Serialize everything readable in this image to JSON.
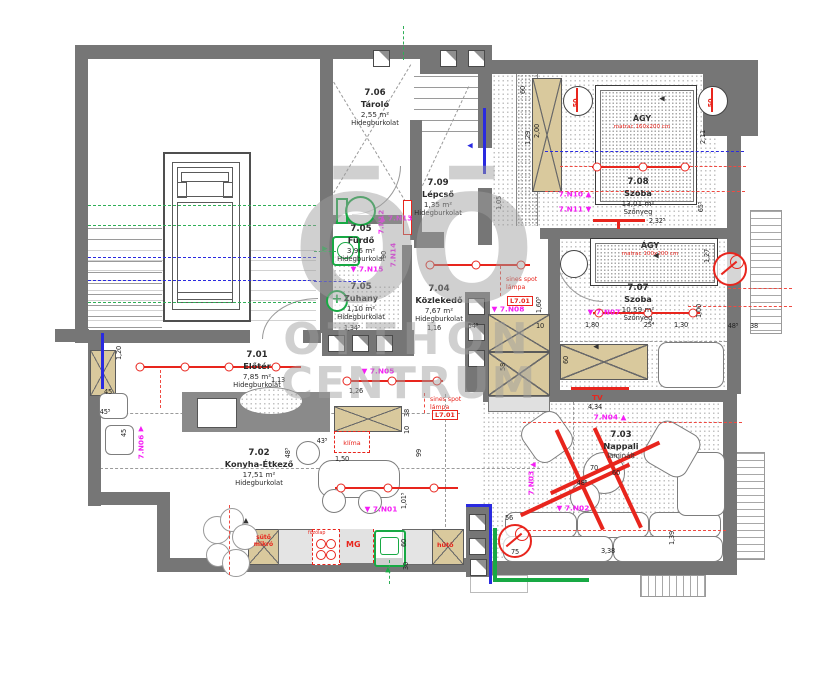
{
  "watermark": {
    "logo": "ŌŌ",
    "line1": "OTTHON",
    "line2": "CENTRUM"
  },
  "rooms": [
    {
      "id": "7.06",
      "name": "Tároló",
      "area": "2,55 m²",
      "floor": "Hidegburkolat"
    },
    {
      "id": "7.09",
      "name": "Lépcső",
      "area": "1,35 m²",
      "floor": "Hidegburkolat"
    },
    {
      "id": "7.05",
      "name": "Fürdő",
      "area": "3,96 m²",
      "floor": "Hidegburkolat"
    },
    {
      "id": "7.05",
      "name": "Zuhany",
      "area": "1,10 m²",
      "floor": "Hidegburkolat"
    },
    {
      "id": "7.04",
      "name": "Közlekedő",
      "area": "7,67 m²",
      "floor": "Hidegburkolat"
    },
    {
      "id": "7.01",
      "name": "Előtér",
      "area": "7,85 m²",
      "floor": "Hidegburkolat"
    },
    {
      "id": "7.02",
      "name": "Konyha-Étkező",
      "area": "17,51 m²",
      "floor": "Hidegburkolat"
    },
    {
      "id": "7.03",
      "name": "Nappali",
      "area": "",
      "floor": "laminált"
    },
    {
      "id": "7.08",
      "name": "Szoba",
      "area": "13,01 m²",
      "floor": "Szőnyeg"
    },
    {
      "id": "7.07",
      "name": "Szoba",
      "area": "10,59 m²",
      "floor": "Szőnyeg"
    }
  ],
  "furniture": {
    "bed_large": {
      "label": "ÁGY",
      "sub": "matrac 160x200 cm"
    },
    "bed_small": {
      "label": "ÁGY",
      "sub": "matrac 100x200 cm"
    },
    "tv": "TV"
  },
  "appliances": {
    "oven1": "sütő",
    "oven2": "mikró",
    "cooktop": "főzőlap",
    "dishwasher": "MG",
    "fridge": "hűtő",
    "klima": "klíma"
  },
  "lighting": {
    "line1": "sines spot",
    "line2": "lámpa",
    "code": "L7.01"
  },
  "dimensions": [
    {
      "t": "2,32⁵",
      "x": 657,
      "y": 221
    },
    {
      "t": "2,11",
      "x": 703,
      "y": 137,
      "v": 1
    },
    {
      "t": "65⁵",
      "x": 701,
      "y": 207,
      "v": 1
    },
    {
      "t": "1,27",
      "x": 707,
      "y": 256,
      "v": 1
    },
    {
      "t": "1,00",
      "x": 699,
      "y": 311,
      "v": 1
    },
    {
      "t": "48⁵",
      "x": 733,
      "y": 326
    },
    {
      "t": "38",
      "x": 754,
      "y": 326
    },
    {
      "t": "1,80",
      "x": 592,
      "y": 325
    },
    {
      "t": "25⁴",
      "x": 649,
      "y": 325
    },
    {
      "t": "1,30",
      "x": 681,
      "y": 325
    },
    {
      "t": "1,34⁵",
      "x": 352,
      "y": 328
    },
    {
      "t": "1,16",
      "x": 434,
      "y": 328
    },
    {
      "t": "54⁵",
      "x": 473,
      "y": 326
    },
    {
      "t": "10",
      "x": 540,
      "y": 326
    },
    {
      "t": "58",
      "x": 503,
      "y": 367,
      "v": 1
    },
    {
      "t": "60",
      "x": 566,
      "y": 360,
      "v": 1
    },
    {
      "t": "1,60⁵",
      "x": 539,
      "y": 305,
      "v": 1
    },
    {
      "t": "90",
      "x": 384,
      "y": 255,
      "v": 1
    },
    {
      "t": "1,05",
      "x": 499,
      "y": 203,
      "v": 1
    },
    {
      "t": "1,29",
      "x": 528,
      "y": 138,
      "v": 1
    },
    {
      "t": "60",
      "x": 523,
      "y": 90,
      "v": 1
    },
    {
      "t": "2,00",
      "x": 537,
      "y": 131,
      "v": 1
    },
    {
      "t": "1,20",
      "x": 119,
      "y": 353,
      "v": 1
    },
    {
      "t": "45",
      "x": 108,
      "y": 392
    },
    {
      "t": "45⁵",
      "x": 105,
      "y": 412
    },
    {
      "t": "45",
      "x": 124,
      "y": 433,
      "v": 1
    },
    {
      "t": "1,13",
      "x": 278,
      "y": 380
    },
    {
      "t": "1,26",
      "x": 356,
      "y": 391
    },
    {
      "t": "38",
      "x": 407,
      "y": 413,
      "v": 1
    },
    {
      "t": "10",
      "x": 407,
      "y": 430,
      "v": 1
    },
    {
      "t": "99",
      "x": 419,
      "y": 453,
      "v": 1
    },
    {
      "t": "1,50",
      "x": 342,
      "y": 459
    },
    {
      "t": "48⁵",
      "x": 288,
      "y": 453,
      "v": 1
    },
    {
      "t": "43⁵",
      "x": 322,
      "y": 441
    },
    {
      "t": "1,01⁵",
      "x": 404,
      "y": 501,
      "v": 1
    },
    {
      "t": "60",
      "x": 404,
      "y": 543,
      "v": 1
    },
    {
      "t": "30",
      "x": 406,
      "y": 566,
      "v": 1
    },
    {
      "t": "3,38",
      "x": 608,
      "y": 551
    },
    {
      "t": "1,39",
      "x": 672,
      "y": 538,
      "v": 1
    },
    {
      "t": "4,34",
      "x": 595,
      "y": 407
    },
    {
      "t": "70",
      "x": 594,
      "y": 468
    },
    {
      "t": "60",
      "x": 616,
      "y": 473
    },
    {
      "t": "48⁵",
      "x": 582,
      "y": 483
    },
    {
      "t": "56",
      "x": 509,
      "y": 518
    },
    {
      "t": "75",
      "x": 515,
      "y": 552
    },
    {
      "t": "50",
      "x": 576,
      "y": 103,
      "v": 1,
      "c": "red"
    },
    {
      "t": "50",
      "x": 711,
      "y": 103,
      "v": 1,
      "c": "red"
    }
  ],
  "annotations": [
    {
      "t": "▼ 7.N01",
      "x": 381,
      "y": 509
    },
    {
      "t": "▼ 7.N02",
      "x": 573,
      "y": 508
    },
    {
      "t": "7.N03",
      "x": 531,
      "y": 483,
      "v": 1
    },
    {
      "t": "7.N04 ▲",
      "x": 610,
      "y": 417
    },
    {
      "t": "▼ 7.N05",
      "x": 378,
      "y": 371
    },
    {
      "t": "7.N06",
      "x": 141,
      "y": 447,
      "v": 1
    },
    {
      "t": "▼ 7.N07",
      "x": 604,
      "y": 312
    },
    {
      "t": "▼ 7.N08",
      "x": 508,
      "y": 309
    },
    {
      "t": "7.N10 ▲",
      "x": 575,
      "y": 194
    },
    {
      "t": "7.N11 ▼",
      "x": 575,
      "y": 209
    },
    {
      "t": "7.N12",
      "x": 381,
      "y": 222,
      "v": 1
    },
    {
      "t": "▲ 7.N13",
      "x": 396,
      "y": 218
    },
    {
      "t": "7.N14",
      "x": 393,
      "y": 255,
      "v": 1
    },
    {
      "t": "▼ 7.N15",
      "x": 367,
      "y": 269
    }
  ],
  "arrows": [
    {
      "g": "◀",
      "x": 533,
      "y": 465,
      "c": "m"
    },
    {
      "g": "▲",
      "x": 141,
      "y": 429,
      "c": "m"
    },
    {
      "g": "◀",
      "x": 656,
      "y": 256
    },
    {
      "g": "◀",
      "x": 662,
      "y": 99
    },
    {
      "g": "▲",
      "x": 246,
      "y": 521
    },
    {
      "g": "▶",
      "x": 325,
      "y": 249,
      "c": "g"
    },
    {
      "g": "▲",
      "x": 388,
      "y": 570,
      "c": "g"
    },
    {
      "g": "◀",
      "x": 470,
      "y": 146,
      "c": "b"
    },
    {
      "g": "◀",
      "x": 596,
      "y": 347
    }
  ],
  "colors": {
    "wall": "#767676",
    "accent_red": "#e8251d",
    "magenta": "#f51df5",
    "green": "#18a944",
    "blue": "#2a2ae0",
    "wardrobe_tan": "#d9c99d",
    "watermark_gray": "#9e9e9e"
  }
}
